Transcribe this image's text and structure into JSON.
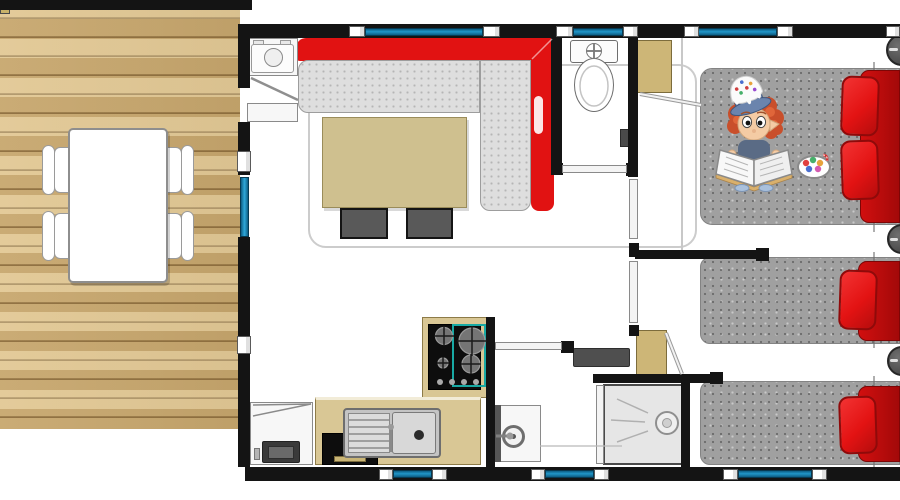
{
  "document": {
    "kind": "floor-plan",
    "view": "top-down",
    "subject": "mobile-home / chalet layout with terrace"
  },
  "colors": {
    "wall": "#141414",
    "window": "#2196c8",
    "deck_wood": "#d6b67b",
    "sofa_red": "#e11212",
    "sofa_seat": "#dedede",
    "table_wood": "#cfc08f",
    "counter": "#d9c795",
    "wardrobe": "#cdb677",
    "mattress": "#a0a0a0",
    "pillow": "#e31313",
    "duvet": "#d10f0f",
    "stool": "#595959",
    "hob_accent": "#18a9a4",
    "tray": "#e6e6e6",
    "appliance_black": "#0d0d0d",
    "bedside": "#4f4f4f"
  },
  "rooms": [
    {
      "id": "terrace",
      "label": "wooden terrace with dining table and four chairs"
    },
    {
      "id": "living-room",
      "label": "L-shaped red sofa, coffee table, two stools, washing machine"
    },
    {
      "id": "kitchen",
      "label": "counter with sink, gas hob, oven, fridge"
    },
    {
      "id": "wc",
      "label": "separate toilet"
    },
    {
      "id": "bathroom",
      "label": "washbasin unit and shower cabin, wardrobe"
    },
    {
      "id": "bedroom-double",
      "label": "double bed with two red pillows and red duvet"
    },
    {
      "id": "bedroom-single-a",
      "label": "single bed with red pillow and duvet"
    },
    {
      "id": "bedroom-single-b",
      "label": "single bed with red pillow and duvet"
    }
  ],
  "windows": [
    "living-room-top-window",
    "wc-top-window",
    "double-bedroom-top-window",
    "kitchen-bottom-window",
    "shower-bottom-window",
    "single-bedroom-bottom-window"
  ],
  "doors": [
    "terrace-sliding-door",
    "entrance-door-swing",
    "wc-door",
    "bedroom-door-1",
    "bedroom-door-2",
    "bathroom-door",
    "shower-door",
    "wardrobe-open-doors"
  ],
  "illustration": {
    "description": "cartoon child with red curly hair wearing a cake-topped blue hat, reading an open book on the double bed, beside a bowl of sweets with a candy cane"
  }
}
